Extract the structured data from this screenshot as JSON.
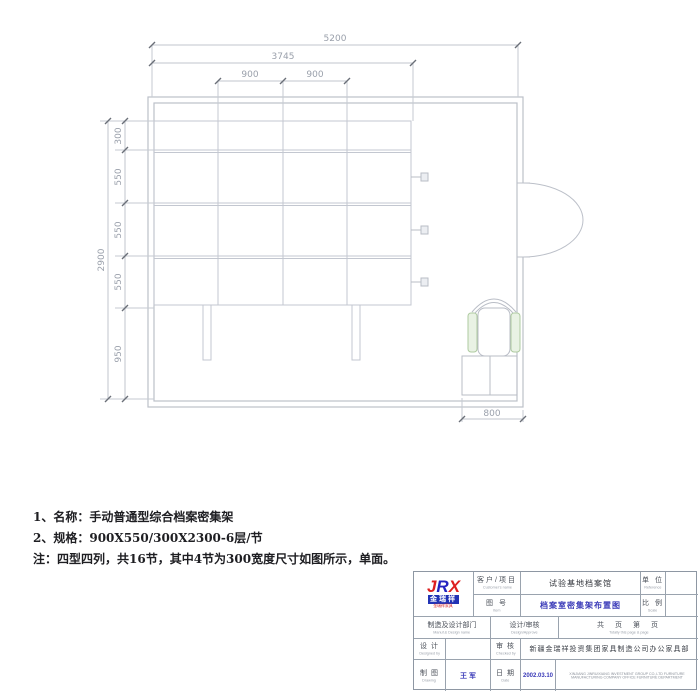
{
  "drawing": {
    "dims": {
      "top": [
        "5200",
        "3745",
        "900",
        "900"
      ],
      "left": [
        "2900",
        "300",
        "550",
        "550",
        "550",
        "950"
      ],
      "bottom": "800"
    }
  },
  "notes": {
    "line1": "1、名称：手动普通型综合档案密集架",
    "line2": "2、规格：900X550/300X2300-6层/节",
    "line3": "注：四型四列，共16节，其中4节为300宽度尺寸如图所示，单面。"
  },
  "logo": {
    "j": "J",
    "r": "R",
    "x": "X",
    "box": "金瑞祥",
    "sub": "金瑞祥家具"
  },
  "title_block": {
    "customer_label_cn": "客户/项目",
    "customer_label_en": "Customer's name",
    "customer_value": "试验基地档案馆",
    "item_label_cn": "图  号",
    "item_label_en": "Item",
    "item_value": "档案室密集架布置图",
    "unit_label_cn": "单 位",
    "unit_label_en": "Reference",
    "scale_label_cn": "比 例",
    "scale_label_en": "Scale",
    "dept_label_cn": "制造及设计部门",
    "dept_label_en": "Manuf.& Design name",
    "design_approve_cn": "设计/审核",
    "design_approve_en": "Design/Approve",
    "pages_cn": "共　页　第　页",
    "pages_en": "Totally this page & page",
    "designed_cn": "设 计",
    "designed_en": "Designed by",
    "checked_cn": "审 核",
    "checked_en": "Checked by",
    "company_cn": "新疆金瑞祥投资集团家具制造公司办公家具部",
    "drawing_cn": "制 图",
    "drawing_en": "Drawing",
    "drafter": "王 军",
    "date_label_cn": "日 期",
    "date_label_en": "Date",
    "date_value": "2002.03.10",
    "company_en": "XINJIANG JINRUIXIANG INVESTMENT GROUP CO.,LTD FURNITURE MANUFACTURING COMPANY OFFICE FURNITURE DEPARTMENT"
  }
}
